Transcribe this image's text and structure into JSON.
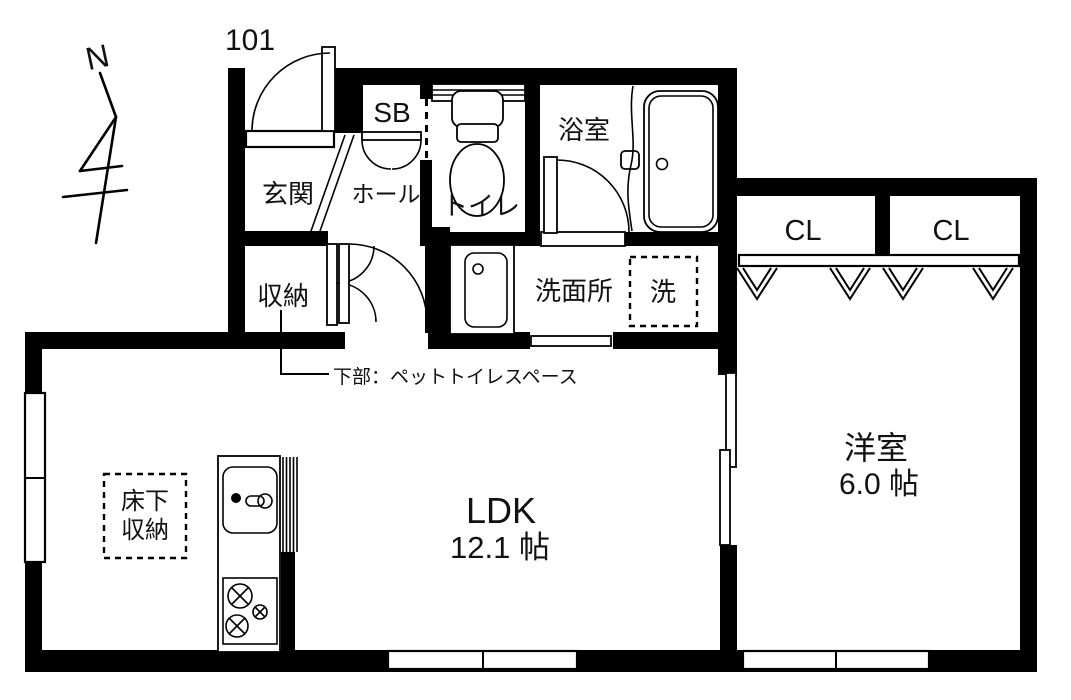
{
  "unit": {
    "number": "101"
  },
  "compass": {
    "label": "N"
  },
  "rooms": {
    "genkan": {
      "label": "玄関"
    },
    "hall": {
      "label": "ホール"
    },
    "shoebox": {
      "label": "SB"
    },
    "toilet": {
      "label": "トイレ"
    },
    "bathroom": {
      "label": "浴室"
    },
    "washroom": {
      "label": "洗面所"
    },
    "laundry": {
      "label": "洗"
    },
    "storage": {
      "label": "収納"
    },
    "closet_left": {
      "label": "CL"
    },
    "closet_right": {
      "label": "CL"
    },
    "ldk": {
      "label": "LDK",
      "size": "12.1 帖"
    },
    "western": {
      "label": "洋室",
      "size": "6.0 帖"
    },
    "underfloor": {
      "line1": "床下",
      "line2": "収納"
    }
  },
  "notes": {
    "storage_lower": "下部：ペットトイレスペース"
  },
  "colors": {
    "wall": "#000000",
    "background": "#ffffff"
  }
}
